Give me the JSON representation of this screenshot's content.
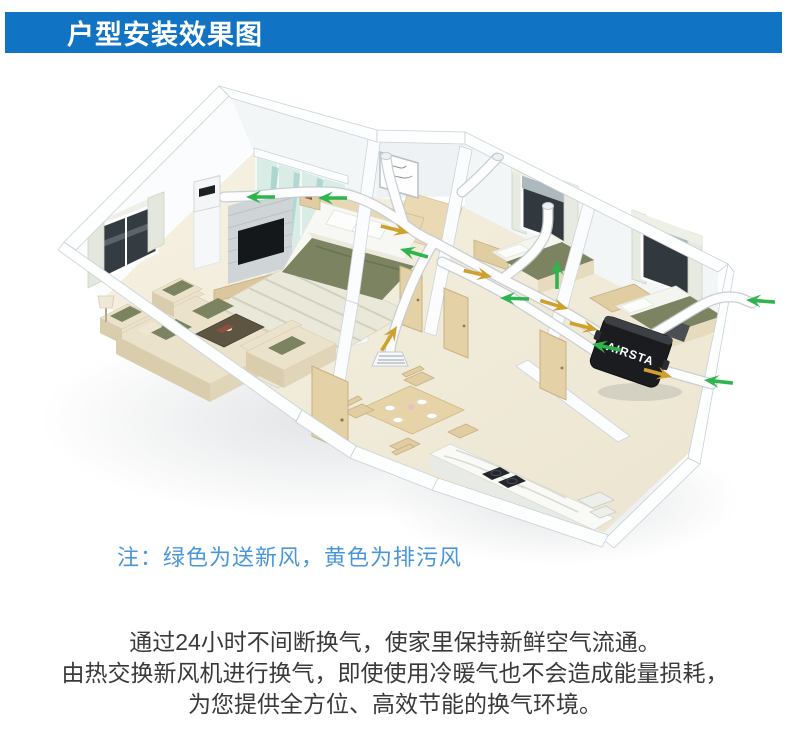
{
  "header": {
    "title": "户型安装效果图",
    "bg_color": "#1173c4",
    "text_color": "#ffffff"
  },
  "diagram": {
    "unit_label": "AIRSTA",
    "note_text": "注：绿色为送新风，黄色为排污风",
    "note_color": "#4a96db",
    "supply_air_color": "#2fb44e",
    "exhaust_air_color": "#cfa02e"
  },
  "description": {
    "text_color": "#3a3a3a",
    "lines": [
      "通过24小时不间断换气，使家里保持新鲜空气流通。",
      "由热交换新风机进行换气，即使使用冷暖气也不会造成能量损耗，",
      "为您提供全方位、高效节能的换气环境。"
    ]
  }
}
